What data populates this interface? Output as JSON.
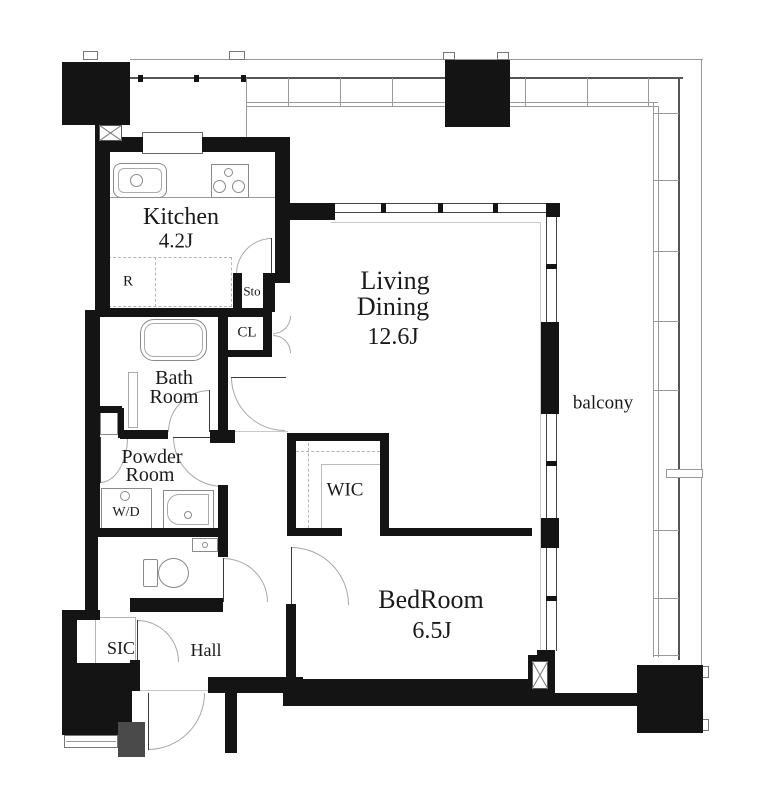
{
  "floorplan": {
    "kitchen": {
      "label": "Kitchen",
      "size": "4.2J"
    },
    "living_dining": {
      "line1": "Living",
      "line2": "Dining",
      "size": "12.6J"
    },
    "bath_room": {
      "line1": "Bath",
      "line2": "Room"
    },
    "powder_room": {
      "line1": "Powder",
      "line2": "Room"
    },
    "bedroom": {
      "label": "BedRoom",
      "size": "6.5J"
    },
    "wic": {
      "label": "WIC"
    },
    "sic": {
      "label": "SIC"
    },
    "hall": {
      "label": "Hall"
    },
    "balcony": {
      "label": "balcony"
    },
    "storage": {
      "label": "Sto"
    },
    "closet": {
      "label": "CL"
    },
    "washer_dryer": {
      "label": "W/D"
    },
    "refrigerator": {
      "label": "R"
    },
    "colors": {
      "wall": "#141414",
      "railing": "#555555",
      "thin_line": "#9a9a9a",
      "text": "#1a1a1a",
      "background": "#ffffff"
    }
  }
}
